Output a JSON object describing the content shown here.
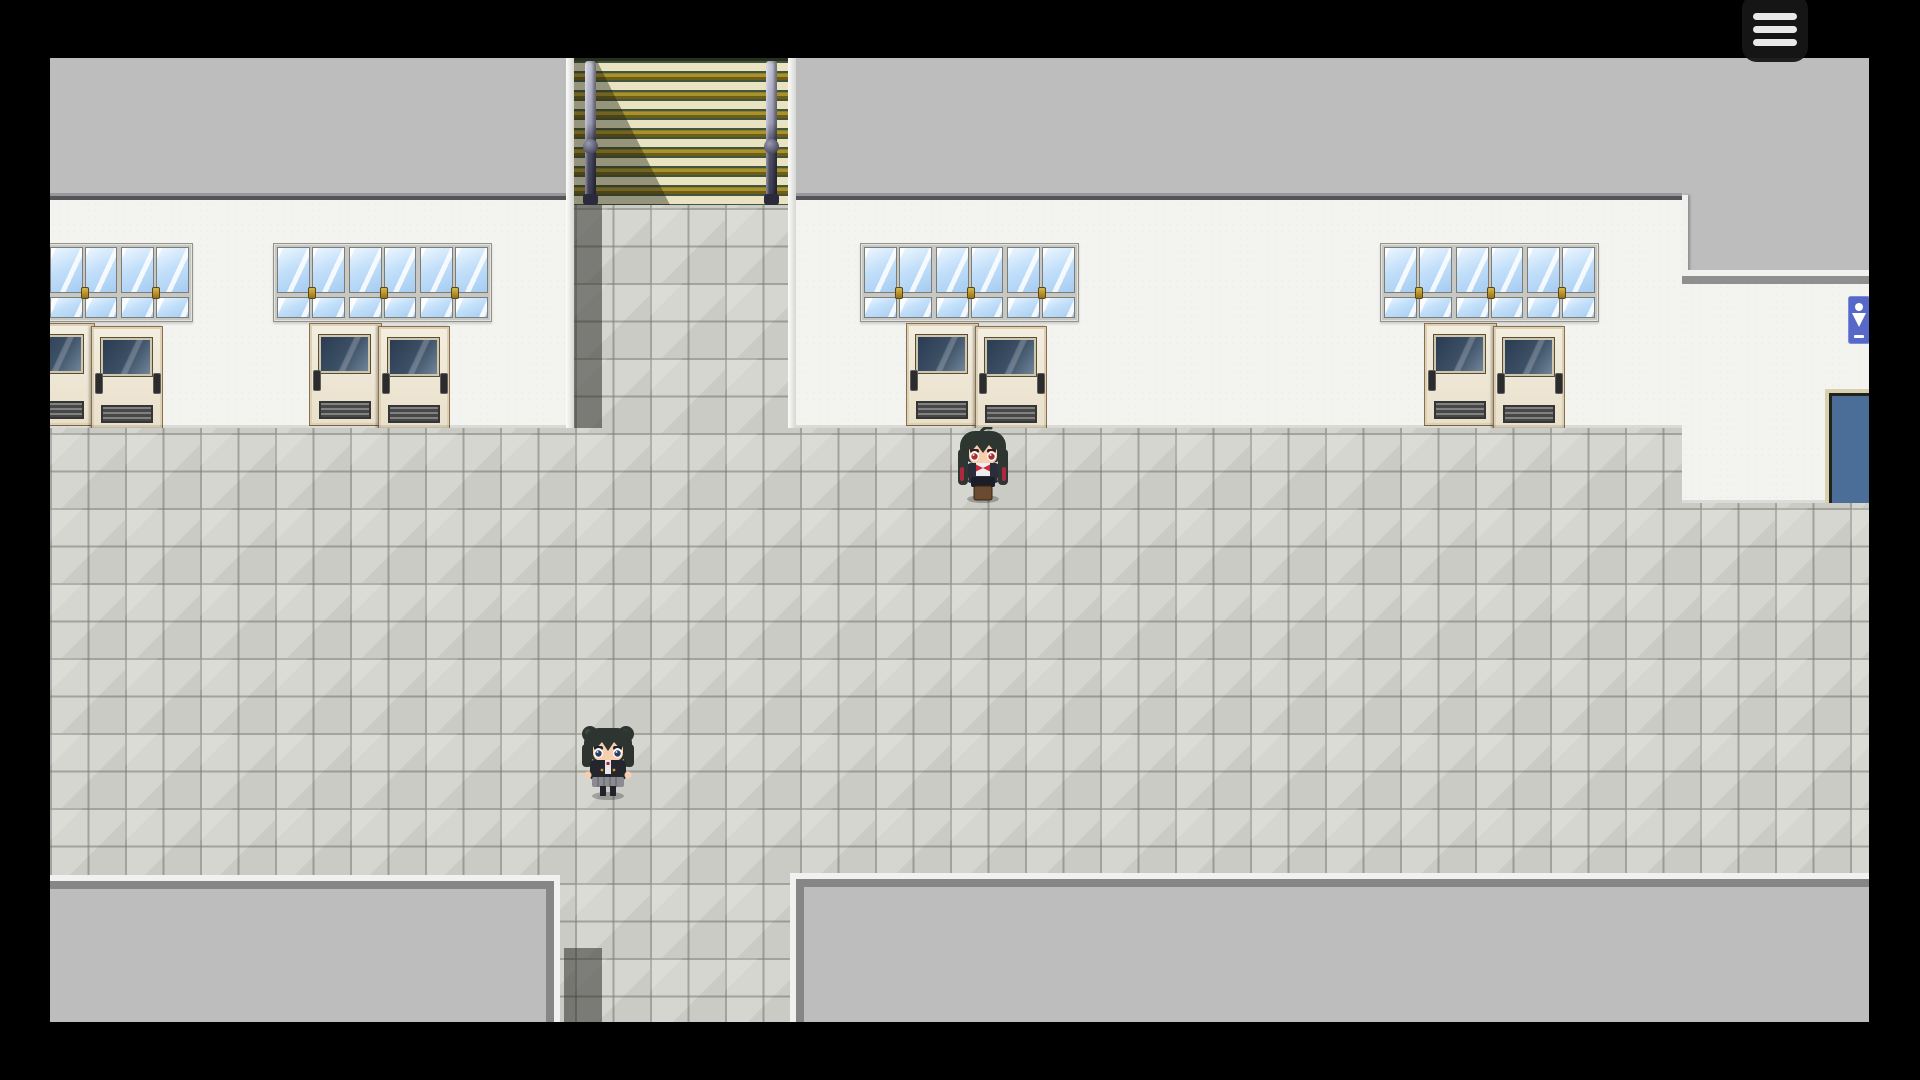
{
  "ui": {
    "menu_button": {
      "icon": "hamburger-menu-icon",
      "bars": 3,
      "bar_color": "#e8e8e8",
      "background": "#1a1a1a"
    }
  },
  "scene": {
    "type": "top-down RPG school hallway",
    "palette": {
      "letterbox_black": "#000000",
      "roof_gray": "#bdbdbd",
      "wall_white": "#f3f3f0",
      "floor_tile": "#d6d6d1",
      "tile_grout": "#787870",
      "shadow_tile": "rgba(38,38,34,0.52)",
      "door_cream": "#efe7d6",
      "door_frame_tan": "#8a6f48",
      "door_window_blue": "#3c5066",
      "window_frame_gray": "#c7c7c3",
      "glass_blue": "#c3e0fa",
      "latch_gold": "#b08a28",
      "stair_cream": "#eae3c1",
      "stair_green": "#42563f",
      "stair_gold": "#a8922e",
      "rail_slate": "#54546c",
      "restroom_sign_blue": "#5668c8",
      "blue_door_steel": "#4b6e99"
    },
    "stairs": {
      "position": "top-center",
      "steps_visible": 8,
      "rails": 2,
      "shadow_on_left": true
    },
    "windows": {
      "groups": 4,
      "units_per_group": 3,
      "leftmost_group_partially_cut": true
    },
    "doors": {
      "pairs": 4,
      "style": "sliding double doors with dark windows and vents",
      "leftmost_pair_partially_cut": true
    },
    "restroom_sign": {
      "icon": "person-icon",
      "background": "#5668c8",
      "location": "right wall, partially cut by screen edge"
    },
    "blue_door": {
      "color": "#4b6e99",
      "location": "bottom of right wall, cut by screen edge"
    },
    "gray_rooms": {
      "count": 2,
      "location": "bottom-left and bottom-right beyond hallway wall"
    },
    "corridors": {
      "up": "staircase top-center",
      "down": "tile corridor bottom-center"
    },
    "characters": [
      {
        "id": "girl-red-eyes",
        "appearance": "long dark hair with red streaks, ahoge, red eyes, dark uniform with white shirt and red bow, brown satchel at feet",
        "facing": "down",
        "location": "in front of center classroom doors"
      },
      {
        "id": "girl-twin-buns",
        "appearance": "dark hair in twin buns, navy blazer, gray pleated skirt, dark blue eyes",
        "facing": "down",
        "location": "lower corridor, left of center"
      }
    ]
  }
}
